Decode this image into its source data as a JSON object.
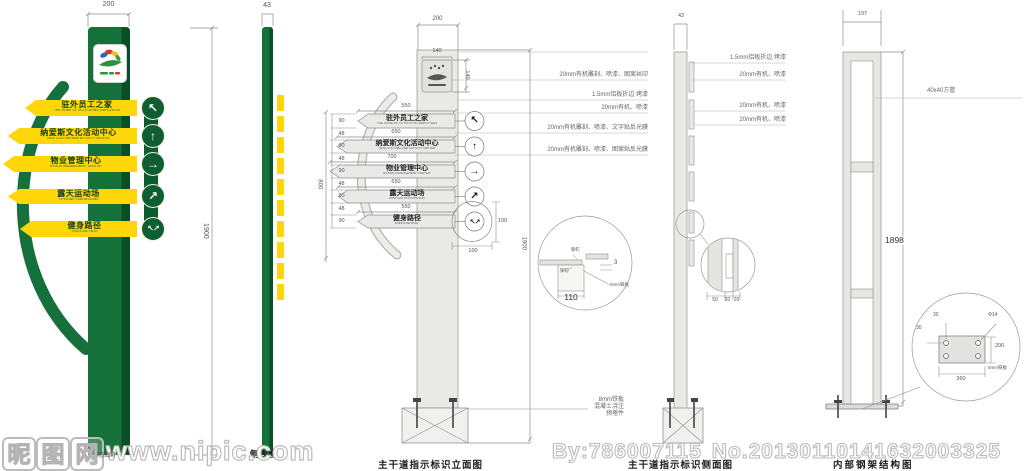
{
  "captions": {
    "side_view": "侧视图",
    "front": "主干道指示标识立面图",
    "side": "主干道指示标识侧面图",
    "frame": "内部钢架结构图"
  },
  "sign": {
    "top_width": "200",
    "side_width": "43",
    "height": "1900",
    "rows": [
      {
        "zh": "驻外员工之家",
        "en": "THE HOME OF OUTSTAYING EMPLOYEES",
        "arrow": "↖",
        "width": "550"
      },
      {
        "zh": "纳爱斯文化活动中心",
        "en": "NICE CULTURE AND ACTIVITY CENTER",
        "arrow": "↑",
        "width": "650"
      },
      {
        "zh": "物业管理中心",
        "en": "ESTATE MANAGEMENT CENTER",
        "arrow": "→",
        "width": "700"
      },
      {
        "zh": "露天运动场",
        "en": "OPEN AIR PLAYGROUND",
        "arrow": "↗",
        "width": "650"
      },
      {
        "zh": "健身路径",
        "en": "EXERCISE PATH",
        "arrow": "↖↗",
        "width": "550"
      }
    ]
  },
  "front": {
    "top_width": "200",
    "logo_w": "140",
    "logo_h": "140",
    "height": "1900",
    "rows_span": "800",
    "left_dims": [
      "90",
      "48",
      "90",
      "48",
      "90",
      "48",
      "90",
      "48",
      "90"
    ],
    "annotations": [
      "20mm有机雕刻、喷漆、图案丝印",
      "1.5mm铝板折边 烤漆",
      "20mm有机、喷漆",
      "20mm有机雕刻、喷漆、文字贴反光膜",
      "20mm有机雕刻、喷漆、图案贴反光膜"
    ],
    "arrow_dim_w": "100",
    "arrow_dim_h": "100",
    "joint": {
      "width": "110",
      "thick": "3",
      "plate": "3mm铁板",
      "rivet1": "铆钉",
      "rivet2": "铆钉"
    },
    "base_notes": [
      "8mm铁板",
      "混凝土浇注",
      "预埋件"
    ]
  },
  "side": {
    "top_width": "43",
    "annotations": [
      "1.5mm铝板折边 烤漆",
      "20mm有机、喷漆",
      "20mm有机、喷漆",
      "20mm有机、喷漆"
    ],
    "layer_dims": [
      "50",
      "20",
      "20"
    ]
  },
  "frame": {
    "top_width": "197",
    "height": "1898",
    "tube": "40x40方管",
    "plate": {
      "edge_a": "30",
      "edge_b": "30",
      "hole": "Φ14",
      "h": "200",
      "w": "360",
      "material": "8mm铁板"
    }
  },
  "watermark": {
    "site_chars": [
      "昵",
      "图",
      "网"
    ],
    "url": "www.nipic.com",
    "small_text": "昵图网",
    "credit_by": "By:786007115",
    "credit_no": "No.20130110141632003325"
  },
  "colors": {
    "green": "#15713a",
    "dark_green": "#0a4e25",
    "yellow": "#ffd60a",
    "line": "#999999"
  }
}
